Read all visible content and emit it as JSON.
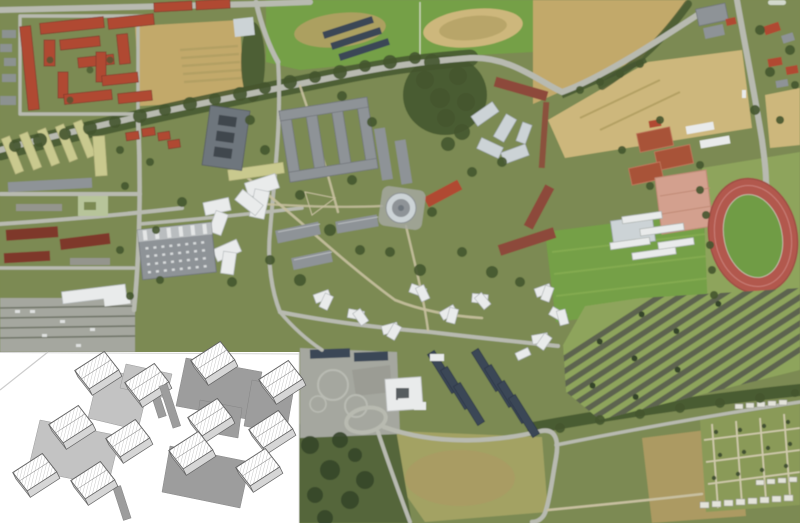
{
  "figure": {
    "kind": "aerial-photograph-with-axonometric-inset",
    "aerial_features": [
      "residential-blocks-red-roofs",
      "agricultural-fields",
      "sports-fields",
      "campus-courtyard-buildings",
      "circular-pavilion",
      "industrial-hall-skylights",
      "tree-lined-avenue",
      "running-track",
      "tennis-courts",
      "clay-sports-ground",
      "greenhouse-rows",
      "large-diagonal-parking-lot",
      "allotment-gardens",
      "tarmac-apron",
      "solar-panel-row-buildings",
      "ring-road-around-meadow",
      "white-roof-housing-clusters"
    ],
    "inset": {
      "style": "axonometric-line-drawing",
      "background": "#ffffff",
      "clusters": [
        {
          "name": "building-cluster-left",
          "blocks": 6
        },
        {
          "name": "building-cluster-right",
          "blocks": 6
        }
      ]
    }
  },
  "palette": {
    "grass": "#7b8a52",
    "grassLight": "#8ea45c",
    "pitch": "#74a046",
    "field": "#c2a96b",
    "fieldLight": "#cdb77c",
    "fieldStripe": "#b3a064",
    "trees": "#45562f",
    "treesDark": "#36452a",
    "road": "#b8bab0",
    "pathTan": "#c8c0a0",
    "bldgGray": "#8e9397",
    "bldgDark": "#6e767d",
    "bldgLight": "#ccd3d6",
    "white": "#e9ebeb",
    "hole": "#40474d",
    "redRoof": "#b04a33",
    "maroon": "#7e382c",
    "brick": "#8d4a3b",
    "paleRoof": "#c9c98e",
    "paleGreen": "#b7c49a",
    "asphalt": "#a5a79f",
    "asphaltDark": "#94958d",
    "parkingRow": "#595f50",
    "solar": "#3a4656",
    "track": "#b2584e",
    "infield": "#6f9c44",
    "clay": "#d3a08e",
    "tennis": "#a85238",
    "meadow": "#a3a264",
    "brownField": "#ac9a62",
    "scrub": "#55663a",
    "allot": "#8a9a58",
    "shed": "#e3e3da",
    "insetBg": "#ffffff",
    "insetGray": "#9d9d9d",
    "insetGrayLight": "#bdbdbd"
  }
}
